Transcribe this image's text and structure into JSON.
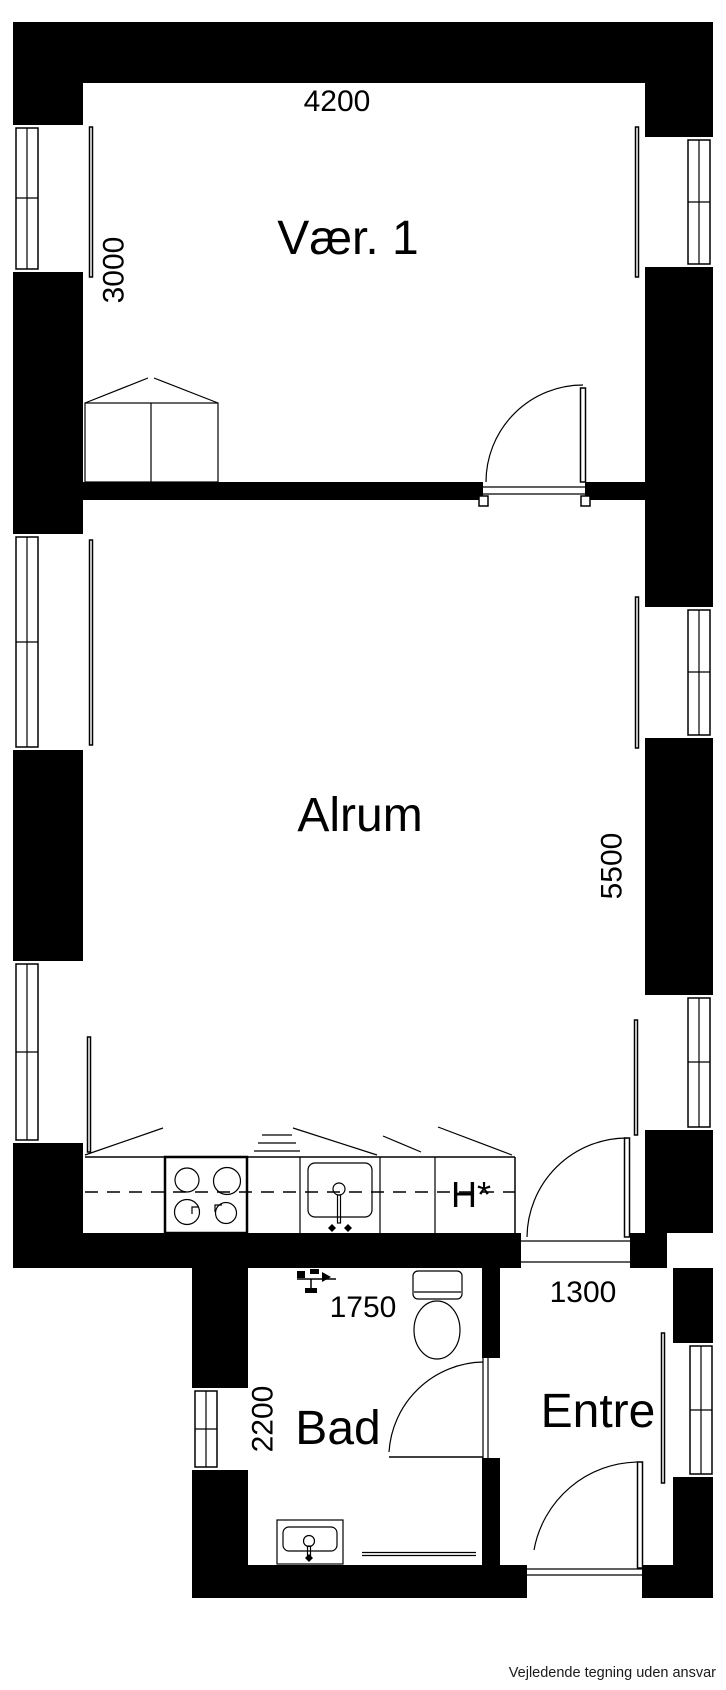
{
  "rooms": {
    "vaer1": {
      "label": "Vær. 1",
      "width_mm": "4200",
      "depth_mm": "3000"
    },
    "alrum": {
      "label": "Alrum",
      "depth_mm": "5500"
    },
    "bad": {
      "label": "Bad",
      "width_mm": "1750",
      "depth_mm": "2200"
    },
    "entre": {
      "label": "Entre",
      "width_mm": "1300"
    }
  },
  "kitchen": {
    "tall_cabinet_label": "H*"
  },
  "footer": {
    "disclaimer": "Vejledende tegning uden ansvar"
  },
  "colors": {
    "wall": "#000000",
    "paper": "#ffffff",
    "line": "#000000"
  }
}
